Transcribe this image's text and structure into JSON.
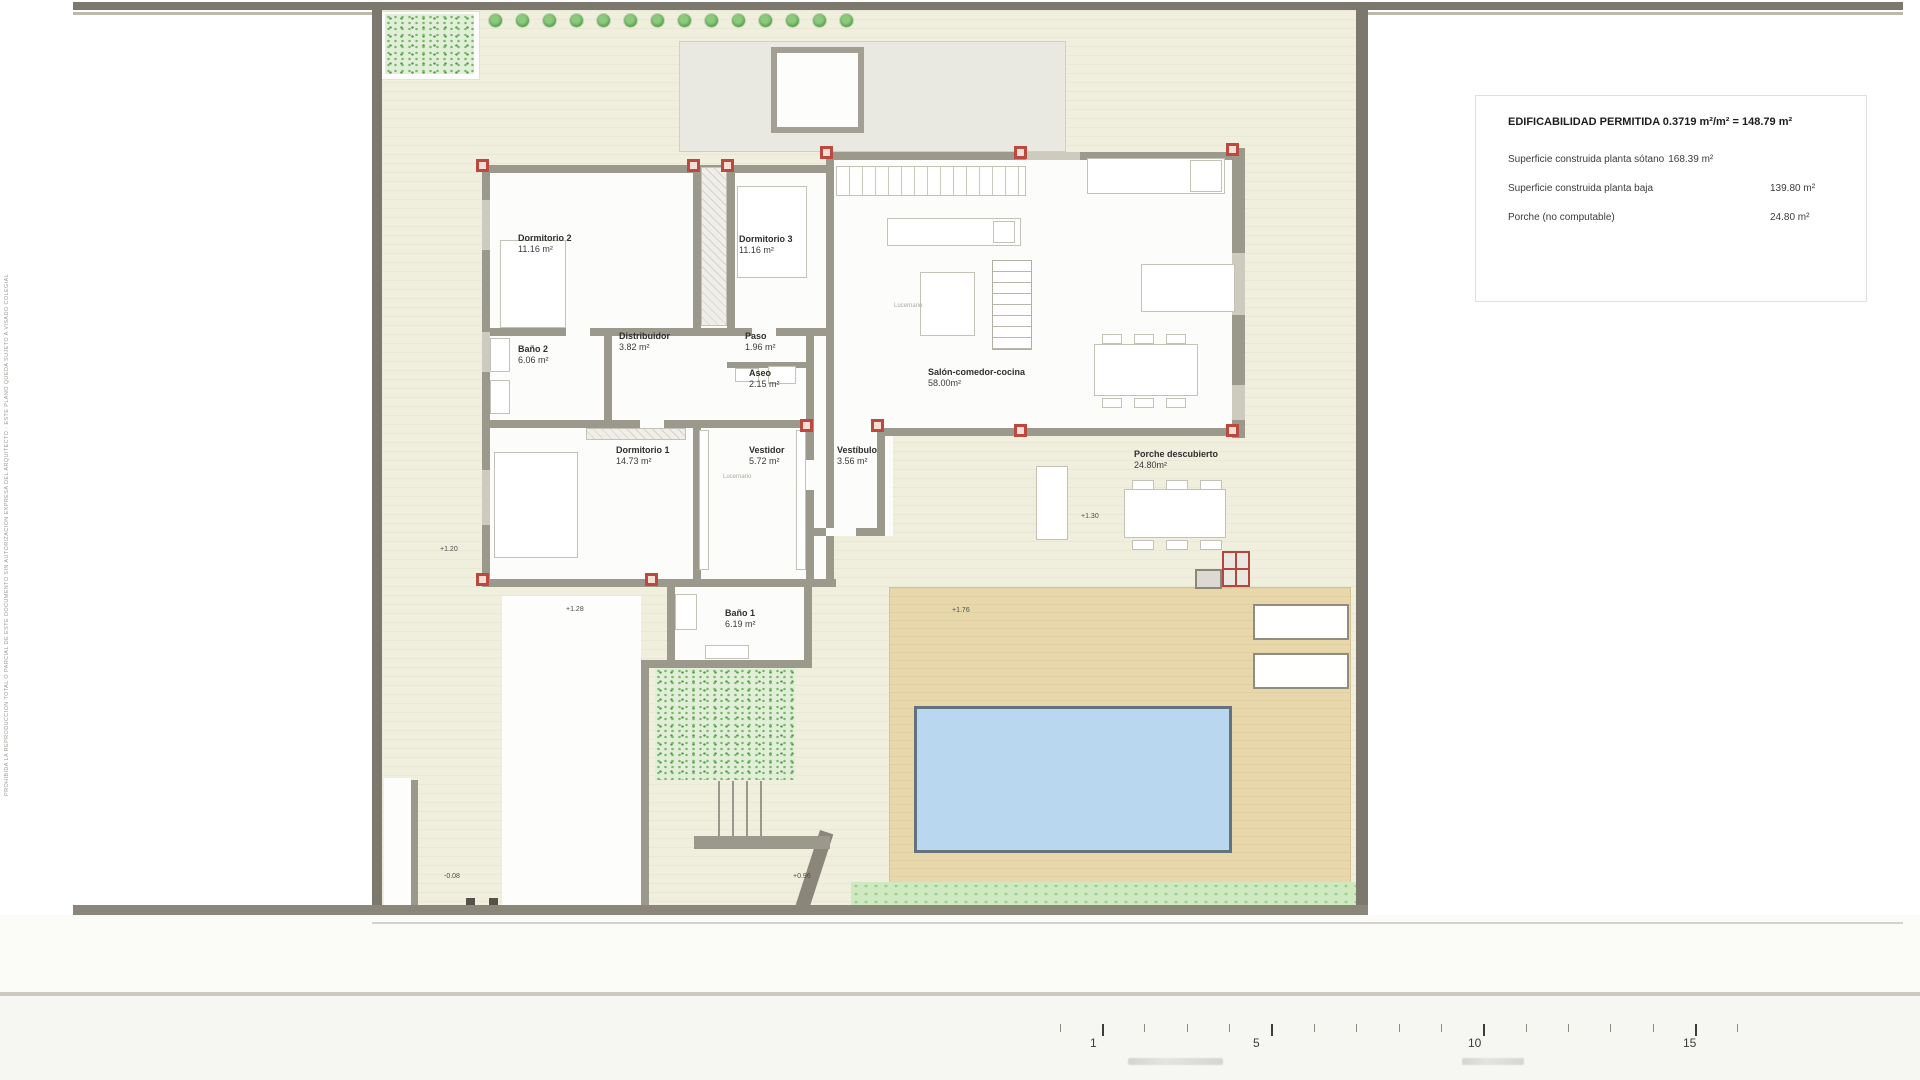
{
  "legend": {
    "title": "EDIFICABILIDAD PERMITIDA 0.3719 m²/m² = 148.79 m²",
    "rows": [
      {
        "label": "Superficie construida planta sótano",
        "value": "168.39 m²"
      },
      {
        "label": "Superficie construida planta baja",
        "value": "139.80 m²"
      },
      {
        "label": "Porche (no computable)",
        "value": "24.80 m²"
      }
    ]
  },
  "rooms": [
    {
      "id": "dormitorio-2",
      "name": "Dormitorio 2",
      "area": "11.16 m²"
    },
    {
      "id": "dormitorio-3",
      "name": "Dormitorio 3",
      "area": "11.16 m²"
    },
    {
      "id": "bano-2",
      "name": "Baño 2",
      "area": "6.06 m²"
    },
    {
      "id": "distribuidor",
      "name": "Distribuidor",
      "area": "3.82 m²"
    },
    {
      "id": "paso",
      "name": "Paso",
      "area": "1.96 m²"
    },
    {
      "id": "aseo",
      "name": "Aseo",
      "area": "2.15 m²"
    },
    {
      "id": "salon",
      "name": "Salón-comedor-cocina",
      "area": "58.00m²"
    },
    {
      "id": "dormitorio-1",
      "name": "Dormitorio 1",
      "area": "14.73 m²"
    },
    {
      "id": "vestidor",
      "name": "Vestidor",
      "area": "5.72 m²"
    },
    {
      "id": "vestibulo",
      "name": "Vestíbulo",
      "area": "3.56 m²"
    },
    {
      "id": "porche",
      "name": "Porche descubierto",
      "area": "24.80m²"
    },
    {
      "id": "bano-1",
      "name": "Baño 1",
      "area": "6.19 m²"
    }
  ],
  "skylight_labels": [
    {
      "id": "lucernario-salon",
      "text": "Lucernario"
    },
    {
      "id": "lucernario-vestidor",
      "text": "Lucernario"
    }
  ],
  "levels": [
    {
      "id": "nivel-120",
      "text": "+1.20"
    },
    {
      "id": "nivel-128",
      "text": "+1.28"
    },
    {
      "id": "nivel-176",
      "text": "+1.76"
    },
    {
      "id": "nivel-130",
      "text": "+1.30"
    },
    {
      "id": "nivel-096",
      "text": "+0.96"
    },
    {
      "id": "nivel-008",
      "text": "-0.08"
    },
    {
      "id": "cota-438",
      "text": "4.38"
    }
  ],
  "scalebar": {
    "labels": [
      "1",
      "5",
      "10",
      "15"
    ]
  },
  "margin_note": "PROHIBIDA LA REPRODUCCION TOTAL O PARCIAL DE ESTE DOCUMENTO SIN AUTORIZACION EXPRESA DEL ARQUITECTO · ESTE PLANO QUEDA SUJETO A VISADO COLEGIAL Y A LAS CONDICIONES URBANISTICAS VIGENTES DE LA PARCELA",
  "colors": {
    "plot": "#f0efde",
    "terrace": "#e7d7ab",
    "pool": "#b9d8f0",
    "wall": "#9b988c",
    "boundary": "#7c786d",
    "column_accent": "#bb493f",
    "green": "#cfe9c0"
  }
}
